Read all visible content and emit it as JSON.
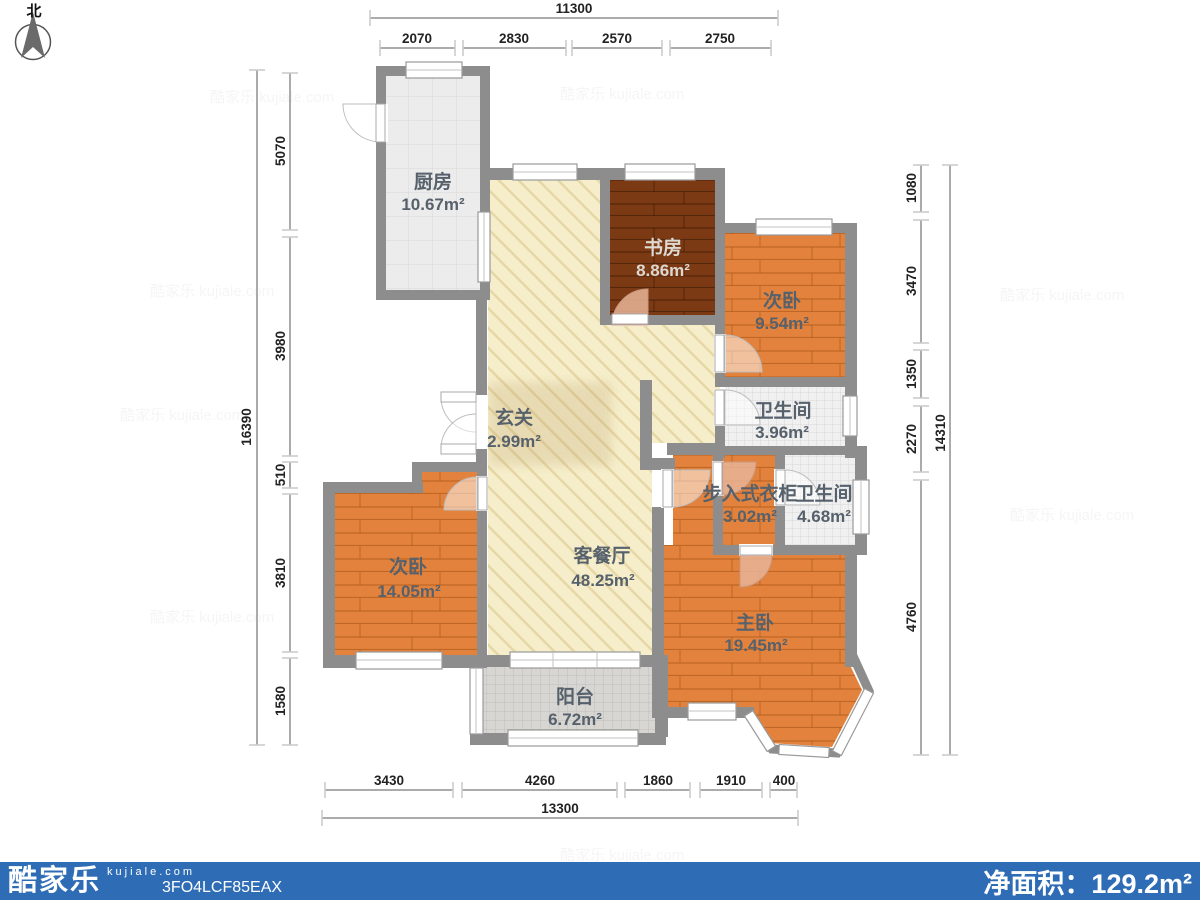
{
  "compass": {
    "label": "北"
  },
  "watermark": {
    "text": "酷家乐 kujiale.com"
  },
  "rooms": {
    "kitchen": {
      "name": "厨房",
      "area": "10.67m²"
    },
    "study": {
      "name": "书房",
      "area": "8.86m²"
    },
    "bedroom2": {
      "name": "次卧",
      "area": "9.54m²"
    },
    "bath1": {
      "name": "卫生间",
      "area": "3.96m²"
    },
    "entry": {
      "name": "玄关",
      "area": "2.99m²"
    },
    "closet": {
      "name": "步入式衣柜",
      "area": "3.02m²"
    },
    "bath2": {
      "name": "卫生间",
      "area": "4.68m²"
    },
    "bedroom3": {
      "name": "次卧",
      "area": "14.05m²"
    },
    "living": {
      "name": "客餐厅",
      "area": "48.25m²"
    },
    "master": {
      "name": "主卧",
      "area": "19.45m²"
    },
    "balcony": {
      "name": "阳台",
      "area": "6.72m²"
    }
  },
  "dims": {
    "top": {
      "total": "11300",
      "segs": [
        "2070",
        "2830",
        "2570",
        "2750"
      ]
    },
    "left": {
      "total": "16390",
      "segs": [
        "5070",
        "3980",
        "510",
        "3810",
        "1580"
      ]
    },
    "right": {
      "total": "14310",
      "segs": [
        "1080",
        "3470",
        "1350",
        "2270",
        "4760"
      ]
    },
    "bottom": {
      "total": "13300",
      "segs": [
        "3430",
        "4260",
        "1860",
        "1910",
        "400"
      ]
    }
  },
  "footer": {
    "brand": "酷家乐",
    "domain": "kujiale.com",
    "code": "3FO4LCF85EAX",
    "area_label": "净面积：",
    "area_value": "129.2m²"
  },
  "colors": {
    "wall": "#8d8d8d",
    "footer_blue": "#2e6db6",
    "wood_orange": "#e2823d",
    "wood_brown": "#7c3a14",
    "living_cream": "#f6eecb"
  }
}
